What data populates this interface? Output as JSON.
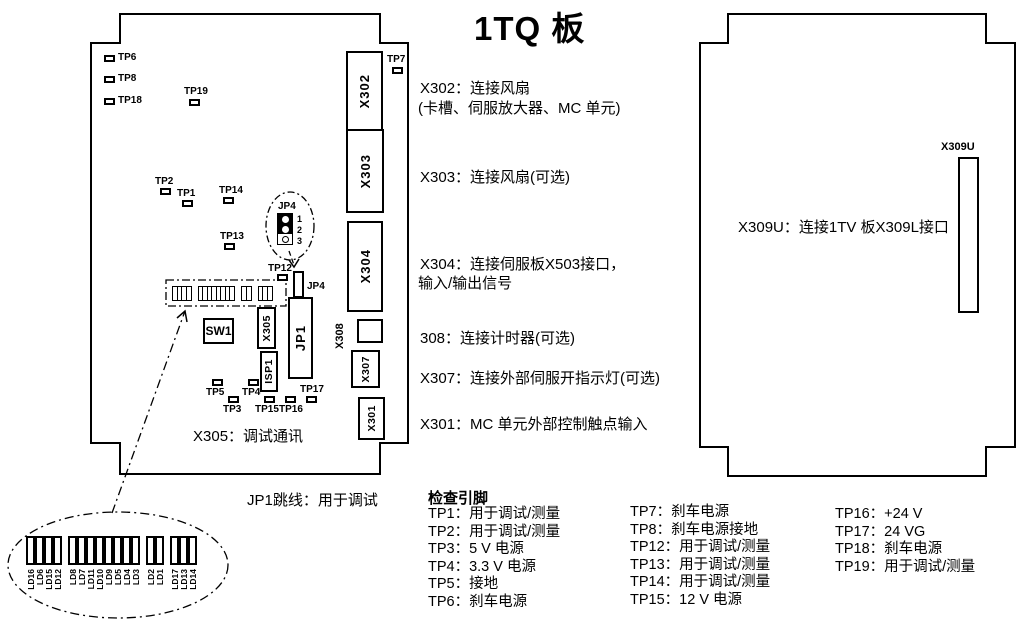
{
  "title": "1TQ 板",
  "left_board": {
    "caption": "X305：调试通讯",
    "connectors": {
      "x302": "X302",
      "x303": "X303",
      "x304": "X304",
      "x308": "X308",
      "x307": "X307",
      "x301": "X301",
      "x305": "X305",
      "jp1": "JP1",
      "isp1": "ISP1",
      "sw1": "SW1",
      "jp4": "JP4"
    },
    "test_points": [
      "TP6",
      "TP8",
      "TP18",
      "TP19",
      "TP2",
      "TP1",
      "TP14",
      "TP13",
      "TP7",
      "TP12",
      "TP5",
      "TP4",
      "TP3",
      "TP15",
      "TP16",
      "TP17"
    ]
  },
  "right_board": {
    "connector": "X309U",
    "caption": "X309U：连接1TV 板X309L接口"
  },
  "annotations": [
    "X302：连接风扇",
    "(卡槽、伺服放大器、MC 单元)",
    "X303：连接风扇(可选)",
    "X304：连接伺服板X503接口，",
    "输入/输出信号",
    "308：连接计时器(可选)",
    "X307：连接外部伺服开指示灯(可选)",
    "X301：MC 单元外部控制触点输入"
  ],
  "jp1_note": "JP1跳线：用于调试",
  "jp4_detail": {
    "label": "JP4",
    "pins": [
      "1",
      "2",
      "3"
    ]
  },
  "led_detail": {
    "groups": [
      [
        "LD16",
        "LD6",
        "LD15",
        "LD12"
      ],
      [
        "LD8",
        "LD7",
        "LD11",
        "LD10",
        "LD9",
        "LD5",
        "LD4",
        "LD3"
      ],
      [
        "LD2",
        "LD1"
      ],
      [
        "LD17",
        "LD13",
        "LD14"
      ]
    ]
  },
  "check_pins": {
    "header": "检查引脚",
    "col1": [
      "TP1：用于调试/测量",
      "TP2：用于调试/测量",
      "TP3：5 V 电源",
      "TP4：3.3 V 电源",
      "TP5：接地",
      "TP6：刹车电源"
    ],
    "col2": [
      "TP7：刹车电源",
      "TP8：刹车电源接地",
      "TP12：用于调试/测量",
      "TP13：用于调试/测量",
      "TP14：用于调试/测量",
      "TP15：12 V 电源"
    ],
    "col3": [
      "TP16：+24 V",
      "TP17：24 VG",
      "TP18：刹车电源",
      "TP19：用于调试/测量"
    ]
  }
}
